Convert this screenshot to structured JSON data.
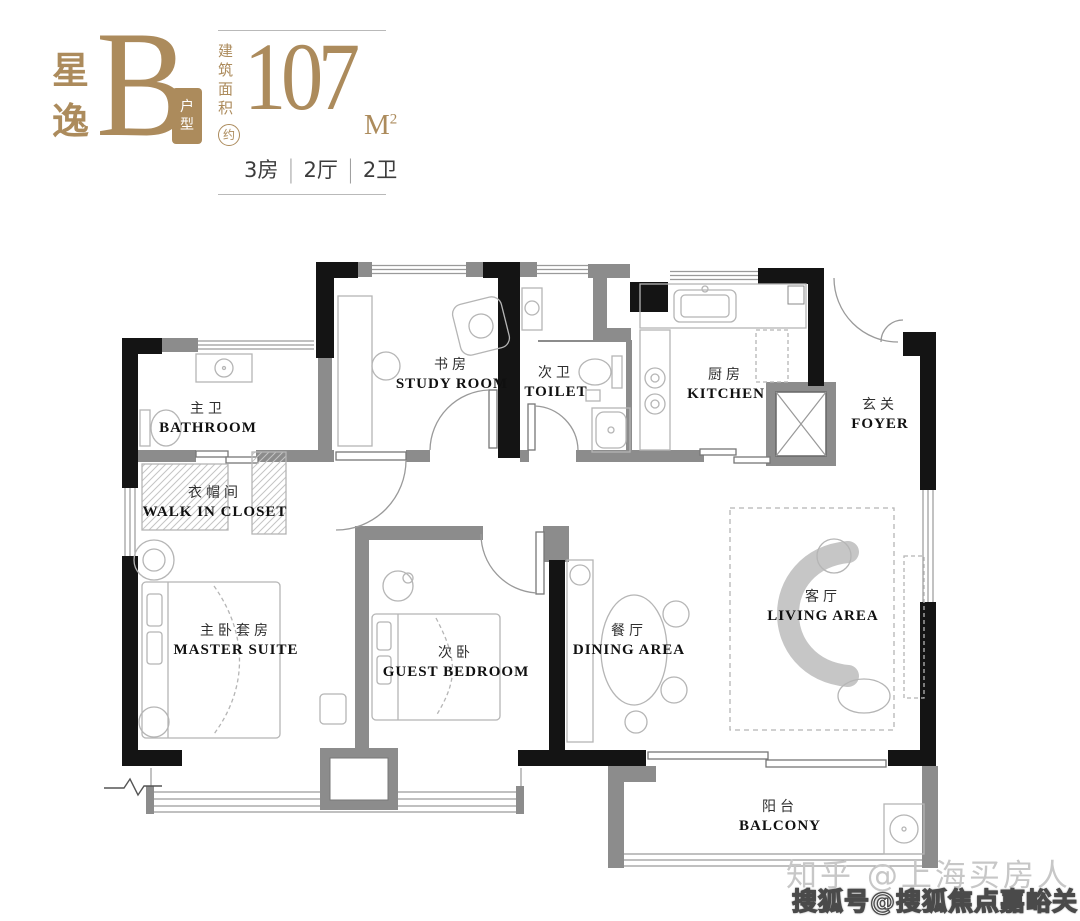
{
  "header": {
    "brand_chars": [
      "星",
      "逸"
    ],
    "type_letter": "B",
    "type_label_chars": [
      "户",
      "型"
    ],
    "area": {
      "prefix_line1": "建筑",
      "prefix_line2": "面积",
      "approx": "约",
      "value": "107",
      "unit": "M",
      "unit_sup": "2"
    },
    "spec": {
      "parts": [
        "3房",
        "2厅",
        "2卫"
      ],
      "separator": "|"
    }
  },
  "rooms": [
    {
      "id": "bathroom",
      "cn": "主卫",
      "en": "BATHROOM"
    },
    {
      "id": "study",
      "cn": "书房",
      "en": "STUDY ROOM"
    },
    {
      "id": "toilet",
      "cn": "次卫",
      "en": "TOILET"
    },
    {
      "id": "kitchen",
      "cn": "厨房",
      "en": "KITCHEN"
    },
    {
      "id": "foyer",
      "cn": "玄关",
      "en": "FOYER"
    },
    {
      "id": "closet",
      "cn": "衣帽间",
      "en": "WALK IN CLOSET"
    },
    {
      "id": "master",
      "cn": "主卧套房",
      "en": "MASTER SUITE"
    },
    {
      "id": "guest",
      "cn": "次卧",
      "en": "GUEST BEDROOM"
    },
    {
      "id": "dining",
      "cn": "餐厅",
      "en": "DINING AREA"
    },
    {
      "id": "living",
      "cn": "客厅",
      "en": "LIVING AREA"
    },
    {
      "id": "balcony",
      "cn": "阳台",
      "en": "BALCONY"
    }
  ],
  "watermarks": {
    "zhihu": "知乎 @上海买房人",
    "sohu": "搜狐号@搜狐焦点嘉峪关站"
  },
  "colors": {
    "gold": "#AC8B5C",
    "wall_black": "#141414",
    "wall_gray": "#8C8C8C",
    "window_line": "#999999",
    "furniture_line": "#B5B5B5",
    "label_dark": "#101010",
    "watermark_gray": "#C7C7C7"
  }
}
